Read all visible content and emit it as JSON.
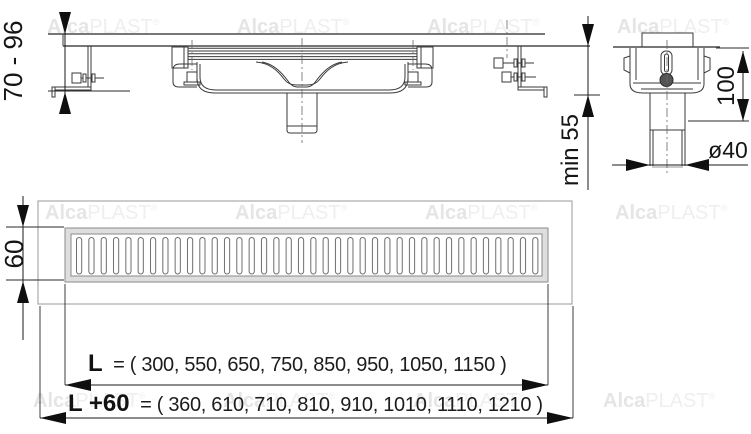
{
  "brand_watermark": {
    "bold": "Alca",
    "light": "PLAST",
    "registered": "®"
  },
  "side_view": {
    "installation_height_label": "70 - 96"
  },
  "section_view": {
    "min_screed_label": "min 55",
    "body_height_label": "100",
    "outlet_diameter_label": "ø40"
  },
  "top_view": {
    "grate_width_label": "60",
    "grate_slot_count": 38,
    "channel_length": {
      "label": "L",
      "values": "= ( 300, 550, 650, 750, 850, 950, 1050, 1150 )"
    },
    "overall_length": {
      "label": "L +60",
      "values": "= ( 360, 610, 710, 810, 910, 1010, 1110, 1210 )"
    }
  }
}
